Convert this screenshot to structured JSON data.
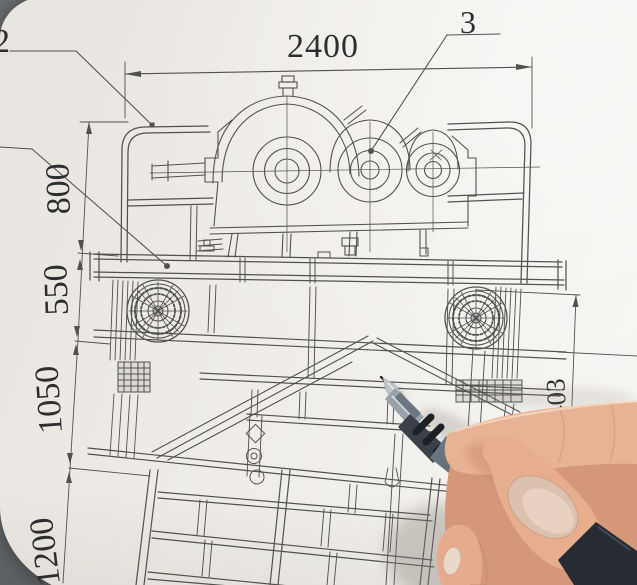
{
  "drawing": {
    "dim_top_width": "2400",
    "balloon_right": "3",
    "balloon_left": "2",
    "dims_left": [
      "800",
      "550",
      "1050",
      "1200"
    ],
    "dim_right_height": "1403"
  },
  "colors": {
    "paper": "#efece7",
    "ink_line": "#3b3b3d",
    "background_gray": "#6f7275",
    "pen_barrel": "#59636e",
    "pen_grip": "#22262b",
    "skin": "#e3aa8c"
  }
}
